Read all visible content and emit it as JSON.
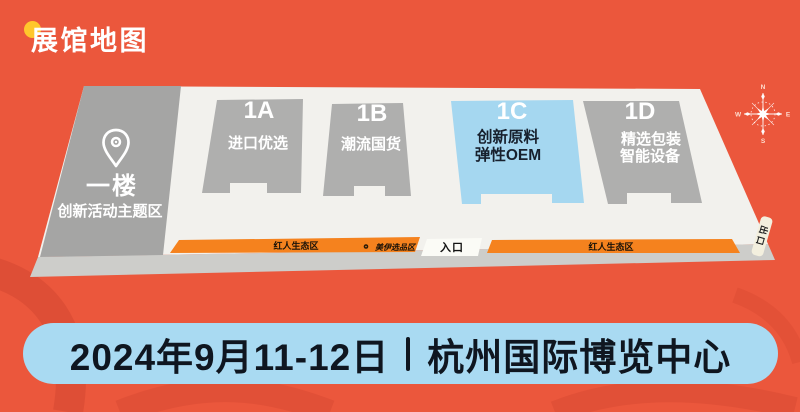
{
  "header": {
    "title": "展馆地图"
  },
  "map": {
    "floor_label": "一楼",
    "floor_sublabel": "创新活动主题区",
    "halls": [
      {
        "id": "1A",
        "lines": [
          "进口优选"
        ]
      },
      {
        "id": "1B",
        "lines": [
          "潮流国货"
        ]
      },
      {
        "id": "1C",
        "lines": [
          "创新原料",
          "弹性OEM"
        ],
        "highlight": true
      },
      {
        "id": "1D",
        "lines": [
          "精选包装",
          "智能设备"
        ]
      }
    ],
    "zones": [
      {
        "label": "红人生态区"
      },
      {
        "label": "美伊选品区"
      },
      {
        "label": "红人生态区"
      }
    ],
    "entrance_label": "入口",
    "exit_label": "出口",
    "compass": {
      "n": "N",
      "e": "E",
      "s": "S",
      "w": "W"
    }
  },
  "footer": {
    "date": "2024年9月11-12日",
    "venue": "杭州国际博览中心"
  },
  "colors": {
    "background": "#EB573C",
    "accent_dot": "#FFC72C",
    "zone_strip": "#F5821E",
    "highlight_hall": "#A5D7F0",
    "banner_bg": "#A9DAF2",
    "banner_text": "#0F1620",
    "hall_gray": "#AFAFAE",
    "floor_white": "#F2F1ED"
  }
}
